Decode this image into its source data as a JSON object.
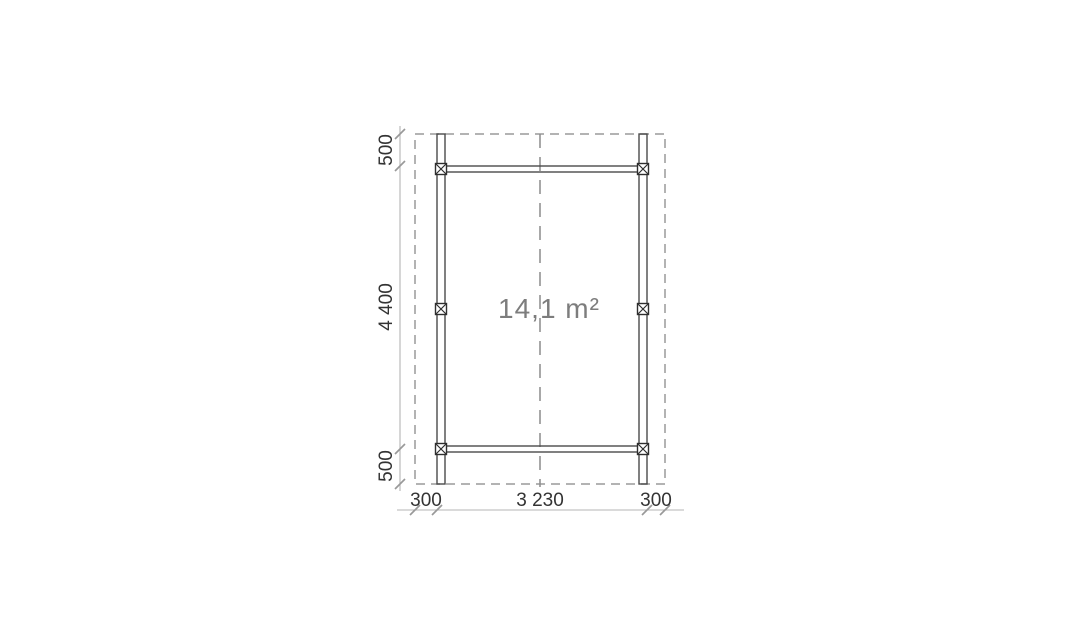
{
  "plan": {
    "area_label": "14,1 m²",
    "vertical_dims": [
      "500",
      "4 400",
      "500"
    ],
    "horizontal_dims": [
      "300",
      "3 230",
      "300"
    ]
  },
  "colors": {
    "background": "#ffffff",
    "structure_line": "#4a4a4a",
    "post_marker": "#2f2f2f",
    "roof_dashed_line": "#9a9a9a",
    "center_dashed_line": "#8c8c8c",
    "dimension_line": "#b4b4b4",
    "dimension_tick": "#999999",
    "dimension_text": "#333333",
    "area_text": "#7d7d7d"
  }
}
